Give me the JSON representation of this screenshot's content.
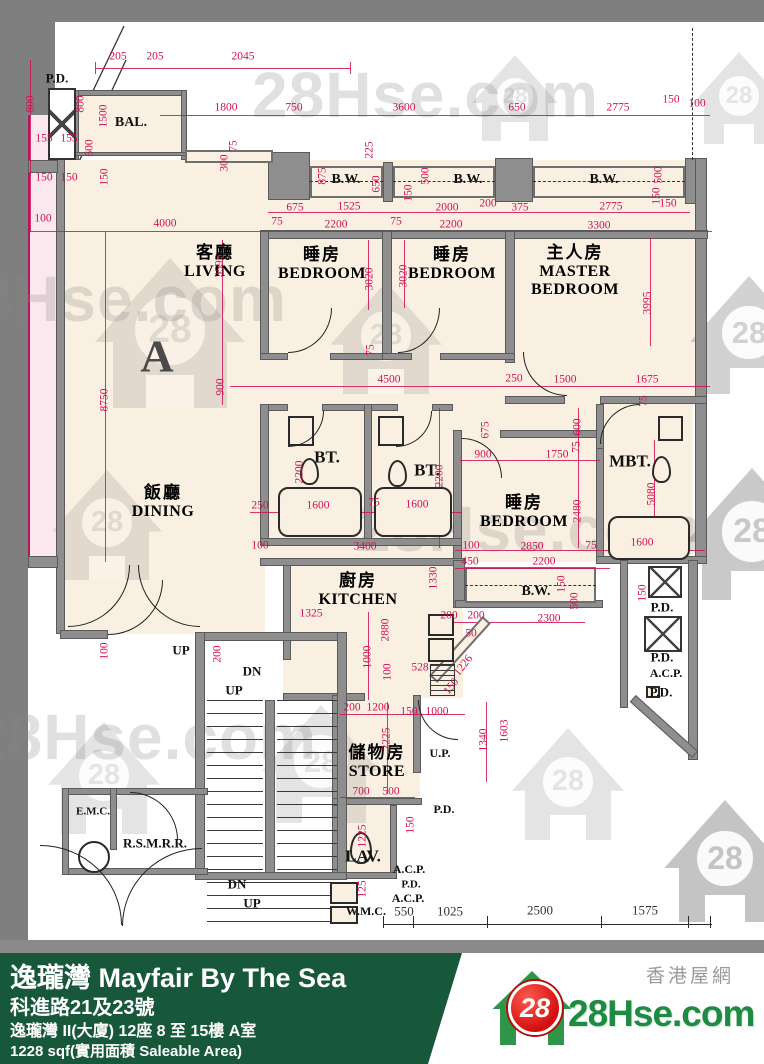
{
  "watermark": {
    "text": "28Hse.com",
    "badge": "28"
  },
  "plan": {
    "unit_letter": "A",
    "rooms": [
      {
        "lines": [
          "客廳",
          "LIVING"
        ],
        "x": 215,
        "y": 238
      },
      {
        "lines": [
          "睡房",
          "BEDROOM"
        ],
        "x": 322,
        "y": 240
      },
      {
        "lines": [
          "睡房",
          "BEDROOM"
        ],
        "x": 452,
        "y": 240
      },
      {
        "lines": [
          "主人房",
          "MASTER",
          "BEDROOM"
        ],
        "x": 575,
        "y": 238
      },
      {
        "lines": [
          "飯廳",
          "DINING"
        ],
        "x": 163,
        "y": 478
      },
      {
        "lines": [
          "睡房",
          "BEDROOM"
        ],
        "x": 524,
        "y": 488
      },
      {
        "lines": [
          "廚房",
          "KITCHEN"
        ],
        "x": 358,
        "y": 566
      },
      {
        "lines": [
          "儲物房",
          "STORE"
        ],
        "x": 377,
        "y": 738
      }
    ],
    "labels": [
      {
        "t": "BAL.",
        "x": 131,
        "y": 123,
        "s": 14
      },
      {
        "t": "B.W.",
        "x": 346,
        "y": 180,
        "s": 14
      },
      {
        "t": "B.W.",
        "x": 468,
        "y": 180,
        "s": 14
      },
      {
        "t": "B.W.",
        "x": 604,
        "y": 180,
        "s": 14
      },
      {
        "t": "B.W.",
        "x": 536,
        "y": 592,
        "s": 14
      },
      {
        "t": "BT.",
        "x": 327,
        "y": 457,
        "s": 17
      },
      {
        "t": "BT.",
        "x": 427,
        "y": 470,
        "s": 17
      },
      {
        "t": "MBT.",
        "x": 630,
        "y": 461,
        "s": 17
      },
      {
        "t": "LAV.",
        "x": 363,
        "y": 856,
        "s": 17
      },
      {
        "t": "W.M.C.",
        "x": 366,
        "y": 911,
        "s": 12
      },
      {
        "t": "U.P.",
        "x": 440,
        "y": 753,
        "s": 12
      },
      {
        "t": "E.M.C.",
        "x": 93,
        "y": 812,
        "s": 11
      },
      {
        "t": "R.S.M.R.R.",
        "x": 155,
        "y": 843,
        "s": 13
      },
      {
        "t": "P.D.",
        "x": 57,
        "y": 78,
        "s": 13
      },
      {
        "t": "P.D.",
        "x": 662,
        "y": 607,
        "s": 13
      },
      {
        "t": "P.D.",
        "x": 662,
        "y": 657,
        "s": 13
      },
      {
        "t": "A.C.P.",
        "x": 666,
        "y": 673,
        "s": 12
      },
      {
        "t": "P.D.",
        "x": 661,
        "y": 692,
        "s": 13
      },
      {
        "t": "P.D.",
        "x": 444,
        "y": 809,
        "s": 12
      },
      {
        "t": "A.C.P.",
        "x": 409,
        "y": 869,
        "s": 12
      },
      {
        "t": "P.D.",
        "x": 411,
        "y": 885,
        "s": 11
      },
      {
        "t": "A.C.P.",
        "x": 408,
        "y": 898,
        "s": 12
      },
      {
        "t": "UP",
        "x": 181,
        "y": 650,
        "s": 13
      },
      {
        "t": "DN",
        "x": 252,
        "y": 671,
        "s": 13
      },
      {
        "t": "UP",
        "x": 234,
        "y": 690,
        "s": 13
      },
      {
        "t": "DN",
        "x": 237,
        "y": 884,
        "s": 13
      },
      {
        "t": "UP",
        "x": 252,
        "y": 903,
        "s": 13
      }
    ],
    "dims": [
      {
        "t": "205",
        "x": 118,
        "y": 57
      },
      {
        "t": "205",
        "x": 155,
        "y": 57
      },
      {
        "t": "2045",
        "x": 243,
        "y": 57
      },
      {
        "t": "800",
        "x": 31,
        "y": 104,
        "r": 1
      },
      {
        "t": "800",
        "x": 81,
        "y": 104,
        "r": 1
      },
      {
        "t": "1500",
        "x": 104,
        "y": 116,
        "r": 1
      },
      {
        "t": "155",
        "x": 44,
        "y": 139
      },
      {
        "t": "155",
        "x": 69,
        "y": 139
      },
      {
        "t": "600",
        "x": 90,
        "y": 148,
        "r": 1
      },
      {
        "t": "150",
        "x": 44,
        "y": 178
      },
      {
        "t": "150",
        "x": 69,
        "y": 178
      },
      {
        "t": "150",
        "x": 105,
        "y": 177,
        "r": 1
      },
      {
        "t": "100",
        "x": 43,
        "y": 219
      },
      {
        "t": "4000",
        "x": 165,
        "y": 224
      },
      {
        "t": "1800",
        "x": 226,
        "y": 108
      },
      {
        "t": "750",
        "x": 294,
        "y": 108
      },
      {
        "t": "3600",
        "x": 404,
        "y": 108
      },
      {
        "t": "650",
        "x": 517,
        "y": 108
      },
      {
        "t": "2775",
        "x": 618,
        "y": 108
      },
      {
        "t": "150",
        "x": 671,
        "y": 100
      },
      {
        "t": "100",
        "x": 697,
        "y": 104
      },
      {
        "t": "75",
        "x": 234,
        "y": 146,
        "r": 1
      },
      {
        "t": "300",
        "x": 225,
        "y": 163,
        "r": 1
      },
      {
        "t": "875",
        "x": 323,
        "y": 176,
        "r": 1
      },
      {
        "t": "225",
        "x": 370,
        "y": 150,
        "r": 1
      },
      {
        "t": "650",
        "x": 377,
        "y": 184,
        "r": 1
      },
      {
        "t": "150",
        "x": 409,
        "y": 193,
        "r": 1
      },
      {
        "t": "500",
        "x": 426,
        "y": 176,
        "r": 1
      },
      {
        "t": "500",
        "x": 659,
        "y": 175,
        "r": 1
      },
      {
        "t": "150",
        "x": 657,
        "y": 196,
        "r": 1
      },
      {
        "t": "675",
        "x": 295,
        "y": 208
      },
      {
        "t": "1525",
        "x": 349,
        "y": 207
      },
      {
        "t": "2000",
        "x": 447,
        "y": 208
      },
      {
        "t": "200",
        "x": 488,
        "y": 204
      },
      {
        "t": "375",
        "x": 520,
        "y": 208
      },
      {
        "t": "2775",
        "x": 611,
        "y": 207
      },
      {
        "t": "150",
        "x": 668,
        "y": 204
      },
      {
        "t": "75",
        "x": 277,
        "y": 222
      },
      {
        "t": "2200",
        "x": 336,
        "y": 225
      },
      {
        "t": "75",
        "x": 396,
        "y": 222
      },
      {
        "t": "2200",
        "x": 451,
        "y": 225
      },
      {
        "t": "3300",
        "x": 599,
        "y": 226
      },
      {
        "t": "3595",
        "x": 220,
        "y": 266,
        "r": 1
      },
      {
        "t": "3020",
        "x": 370,
        "y": 279,
        "r": 1
      },
      {
        "t": "3020",
        "x": 404,
        "y": 276,
        "r": 1
      },
      {
        "t": "3995",
        "x": 648,
        "y": 303,
        "r": 1
      },
      {
        "t": "8750",
        "x": 105,
        "y": 400,
        "r": 1
      },
      {
        "t": "900",
        "x": 221,
        "y": 387,
        "r": 1
      },
      {
        "t": "75",
        "x": 371,
        "y": 350,
        "r": 1
      },
      {
        "t": "4500",
        "x": 389,
        "y": 380
      },
      {
        "t": "250",
        "x": 514,
        "y": 379
      },
      {
        "t": "1500",
        "x": 565,
        "y": 380
      },
      {
        "t": "1675",
        "x": 647,
        "y": 380
      },
      {
        "t": "75",
        "x": 644,
        "y": 401,
        "r": 1
      },
      {
        "t": "675",
        "x": 486,
        "y": 430,
        "r": 1
      },
      {
        "t": "600",
        "x": 578,
        "y": 427,
        "r": 1
      },
      {
        "t": "900",
        "x": 483,
        "y": 455
      },
      {
        "t": "1750",
        "x": 557,
        "y": 455
      },
      {
        "t": "75",
        "x": 577,
        "y": 447,
        "r": 1
      },
      {
        "t": "2200",
        "x": 300,
        "y": 472,
        "r": 1
      },
      {
        "t": "2200",
        "x": 440,
        "y": 476,
        "r": 1
      },
      {
        "t": "2480",
        "x": 578,
        "y": 511,
        "r": 1
      },
      {
        "t": "5080",
        "x": 652,
        "y": 494,
        "r": 1
      },
      {
        "t": "250",
        "x": 260,
        "y": 506
      },
      {
        "t": "1600",
        "x": 318,
        "y": 506
      },
      {
        "t": "75",
        "x": 374,
        "y": 503
      },
      {
        "t": "1600",
        "x": 417,
        "y": 505
      },
      {
        "t": "100",
        "x": 471,
        "y": 546
      },
      {
        "t": "2850",
        "x": 532,
        "y": 547
      },
      {
        "t": "75",
        "x": 591,
        "y": 546
      },
      {
        "t": "1600",
        "x": 642,
        "y": 543
      },
      {
        "t": "3400",
        "x": 365,
        "y": 547
      },
      {
        "t": "100",
        "x": 260,
        "y": 546
      },
      {
        "t": "450",
        "x": 470,
        "y": 562
      },
      {
        "t": "2200",
        "x": 544,
        "y": 562
      },
      {
        "t": "150",
        "x": 562,
        "y": 584,
        "r": 1
      },
      {
        "t": "500",
        "x": 575,
        "y": 601,
        "r": 1
      },
      {
        "t": "2300",
        "x": 549,
        "y": 619
      },
      {
        "t": "200",
        "x": 449,
        "y": 616
      },
      {
        "t": "200",
        "x": 476,
        "y": 616
      },
      {
        "t": "50",
        "x": 471,
        "y": 634
      },
      {
        "t": "1325",
        "x": 311,
        "y": 614
      },
      {
        "t": "2880",
        "x": 386,
        "y": 630,
        "r": 1
      },
      {
        "t": "1000",
        "x": 368,
        "y": 657,
        "r": 1
      },
      {
        "t": "100",
        "x": 388,
        "y": 672,
        "r": 1
      },
      {
        "t": "1330",
        "x": 434,
        "y": 578,
        "r": 1
      },
      {
        "t": "1226",
        "x": 464,
        "y": 666,
        "r": -52
      },
      {
        "t": "528",
        "x": 420,
        "y": 668
      },
      {
        "t": "150",
        "x": 452,
        "y": 687,
        "r": -52
      },
      {
        "t": "200",
        "x": 352,
        "y": 708
      },
      {
        "t": "1200",
        "x": 378,
        "y": 708
      },
      {
        "t": "150",
        "x": 409,
        "y": 712
      },
      {
        "t": "1000",
        "x": 437,
        "y": 712
      },
      {
        "t": "100",
        "x": 105,
        "y": 651,
        "r": 1
      },
      {
        "t": "200",
        "x": 218,
        "y": 654,
        "r": 1
      },
      {
        "t": "2225",
        "x": 387,
        "y": 739,
        "r": 1
      },
      {
        "t": "1340",
        "x": 484,
        "y": 740,
        "r": 1
      },
      {
        "t": "1603",
        "x": 505,
        "y": 731,
        "r": 1
      },
      {
        "t": "700",
        "x": 361,
        "y": 792
      },
      {
        "t": "500",
        "x": 391,
        "y": 792
      },
      {
        "t": "1225",
        "x": 363,
        "y": 836,
        "r": 1
      },
      {
        "t": "150",
        "x": 411,
        "y": 825,
        "r": 1
      },
      {
        "t": "125",
        "x": 363,
        "y": 889,
        "r": 1
      },
      {
        "t": "150",
        "x": 643,
        "y": 593,
        "r": 1
      },
      {
        "t": "550",
        "x": 404,
        "y": 911,
        "c": "k"
      },
      {
        "t": "1025",
        "x": 450,
        "y": 911,
        "c": "k"
      },
      {
        "t": "2500",
        "x": 540,
        "y": 910,
        "c": "k"
      },
      {
        "t": "1575",
        "x": 645,
        "y": 910,
        "c": "k"
      }
    ]
  },
  "footer": {
    "title": "逸瓏灣 Mayfair By The Sea",
    "address": "科進路21及23號",
    "building": "逸瓏灣 II(大廈) 12座 8 至 15樓 A室",
    "area": "1228 sqf(實用面積 Saleable Area)",
    "site_name": "香港屋網",
    "logo_text": "28Hse.com",
    "logo_badge": "28"
  }
}
